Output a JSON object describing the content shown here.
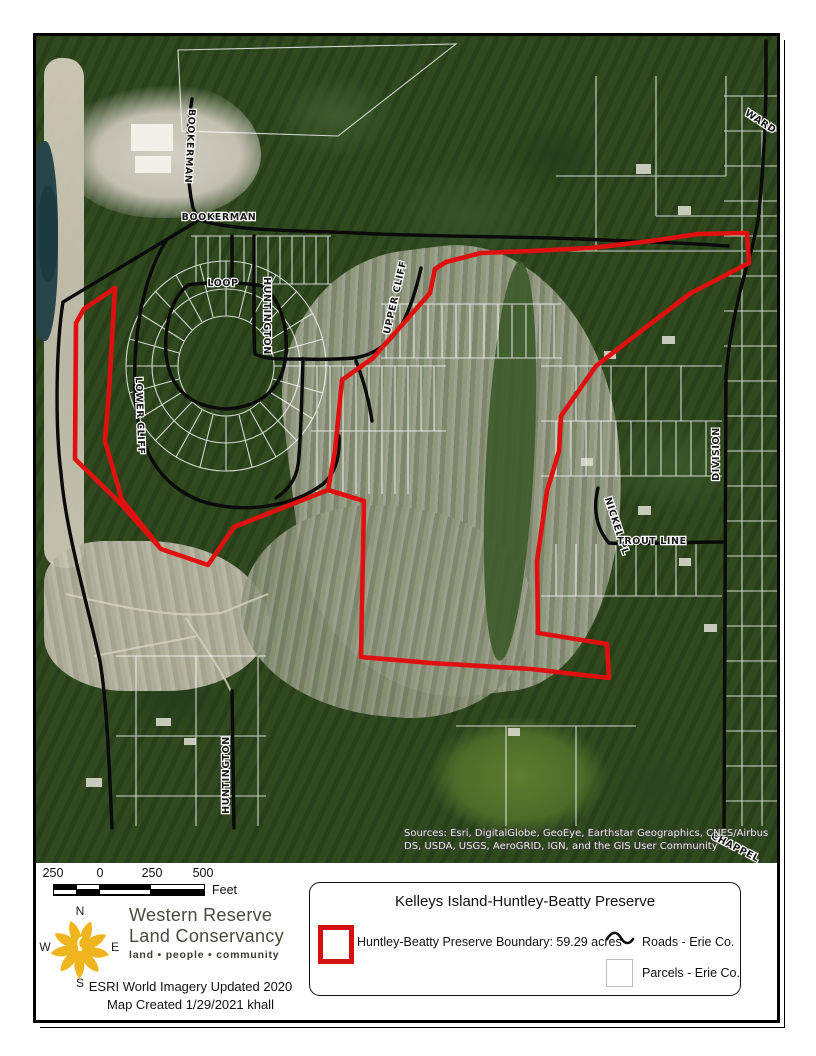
{
  "map": {
    "road_labels": [
      {
        "text": "BOOKERMAN"
      },
      {
        "text": "BOOKERMAN"
      },
      {
        "text": "WARD"
      },
      {
        "text": "LOOP"
      },
      {
        "text": "HUNTINGTON"
      },
      {
        "text": "UPPER CLIFF"
      },
      {
        "text": "LOWER CLIFF"
      },
      {
        "text": "DIVISION"
      },
      {
        "text": "NICKEL PL"
      },
      {
        "text": "TROUT LINE"
      },
      {
        "text": "HUNTINGTON"
      },
      {
        "text": "CHAPPEL"
      }
    ],
    "sources_line1": "Sources: Esri, DigitalGlobe, GeoEye, Earthstar Geographics, CNES/Airbus",
    "sources_line2": "DS, USDA, USGS, AeroGRID, IGN, and the GIS User Community"
  },
  "scale_bar": {
    "tick_labels": [
      "250",
      "0",
      "250",
      "500"
    ],
    "unit": "Feet"
  },
  "compass": {
    "north": "N",
    "west": "W",
    "east": "E",
    "south": "S"
  },
  "organization": {
    "name_line1": "Western Reserve",
    "name_line2": "Land Conservancy",
    "tagline": "land • people • community"
  },
  "credits": {
    "imagery": "ESRI World Imagery Updated 2020",
    "created": "Map Created 1/29/2021 khall"
  },
  "legend": {
    "title": "Kelleys Island-Huntley-Beatty Preserve",
    "items": [
      {
        "label": "Huntley-Beatty Preserve Boundary: 59.29 acres"
      },
      {
        "label": "Roads - Erie Co."
      },
      {
        "label": "Parcels - Erie Co."
      }
    ]
  },
  "colors": {
    "boundary": "#e01010",
    "roads": "#0a0a0a",
    "parcel_lines": "#ffffff",
    "logo": "#f0b41e"
  }
}
